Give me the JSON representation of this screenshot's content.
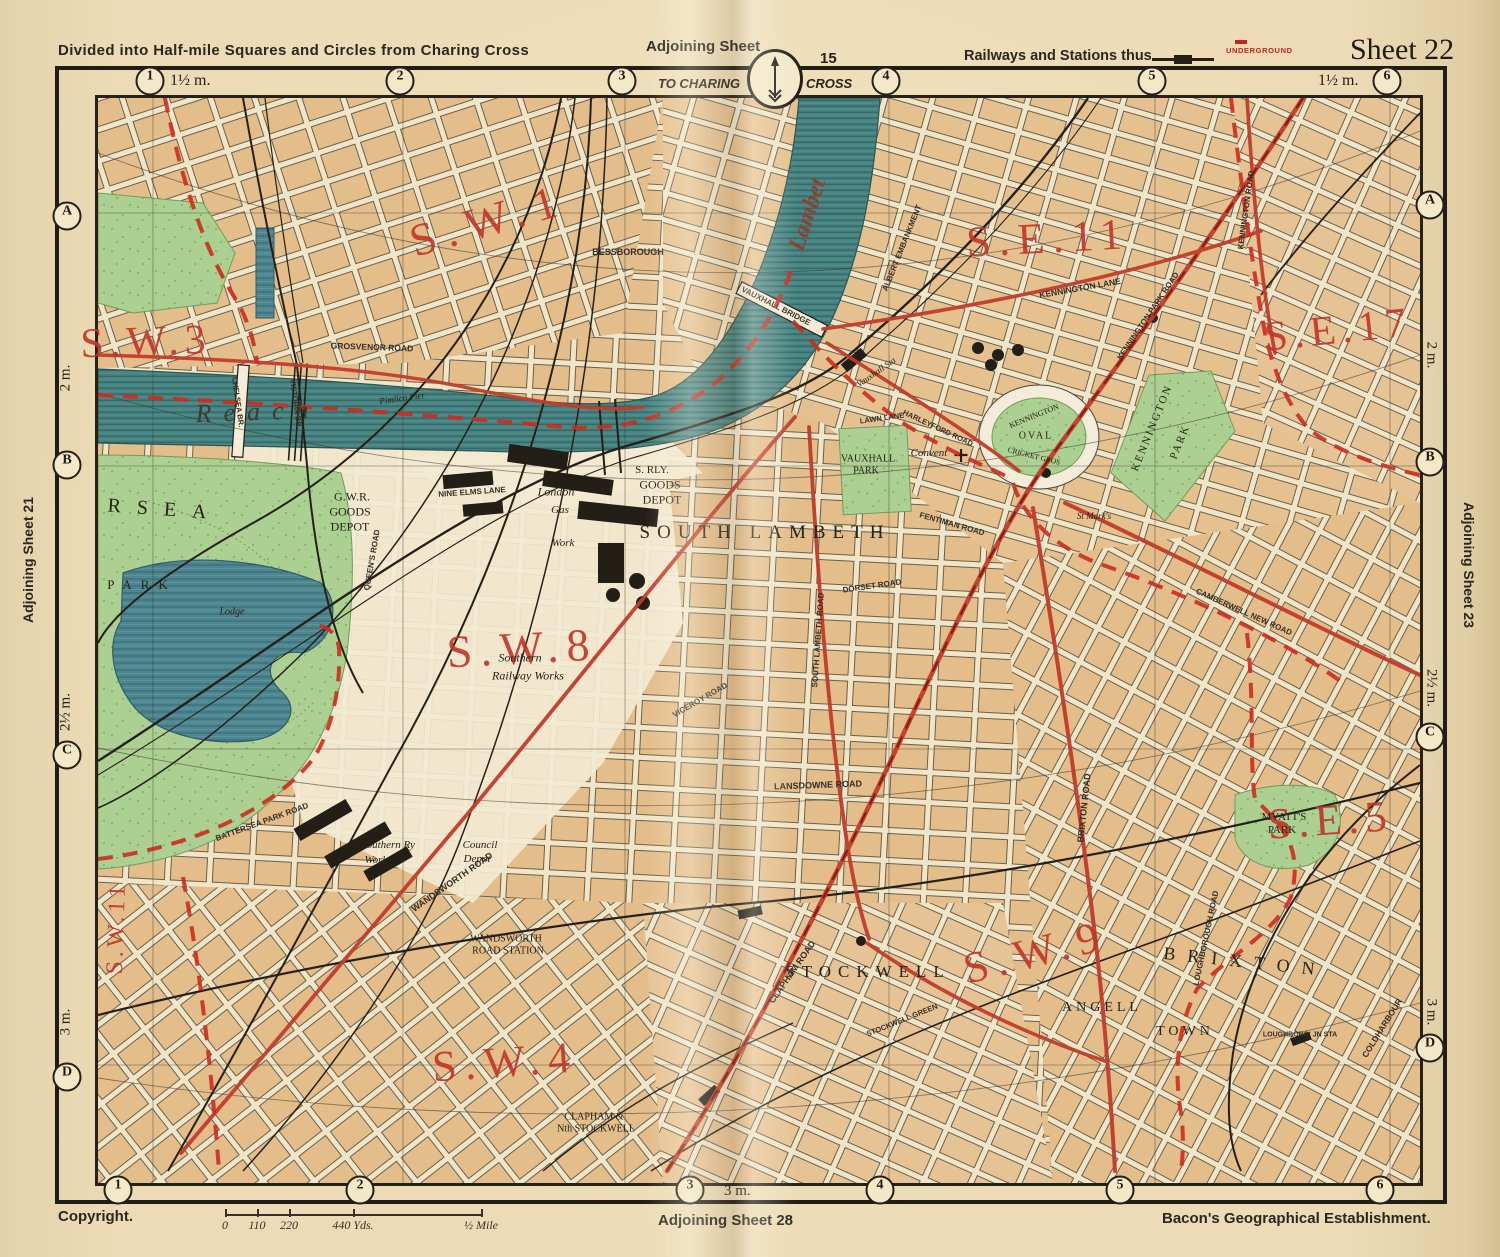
{
  "header": {
    "left": "Divided into Half-mile Squares and Circles from Charing Cross",
    "adjoining_top": "Adjoining Sheet",
    "adjoining_top_num": "15",
    "railways_legend": "Railways and Stations thus",
    "underground_label": "UNDERGROUND",
    "sheet": "Sheet 22",
    "to_charing": "TO CHARING",
    "cross": "CROSS",
    "compass_icon": "north-arrow"
  },
  "footer": {
    "copyright": "Copyright.",
    "adjoining_bottom": "Adjoining Sheet 28",
    "publisher": "Bacon's Geographical Establishment.",
    "three_m": "3 m.",
    "scale_ticks": [
      {
        "label": "0",
        "x": 225
      },
      {
        "label": "110",
        "x": 257
      },
      {
        "label": "220",
        "x": 289
      },
      {
        "label": "440 Yds.",
        "x": 353
      },
      {
        "label": "½ Mile",
        "x": 481
      }
    ]
  },
  "edges": {
    "top_circles": [
      {
        "n": "1",
        "x": 150
      },
      {
        "n": "2",
        "x": 400
      },
      {
        "n": "3",
        "x": 622
      },
      {
        "n": "4",
        "x": 886
      },
      {
        "n": "5",
        "x": 1152
      },
      {
        "n": "6",
        "x": 1387
      }
    ],
    "bottom_circles": [
      {
        "n": "1",
        "x": 118
      },
      {
        "n": "2",
        "x": 360
      },
      {
        "n": "3",
        "x": 690
      },
      {
        "n": "4",
        "x": 880
      },
      {
        "n": "5",
        "x": 1120
      },
      {
        "n": "6",
        "x": 1380
      }
    ],
    "top_dist_left": "1½ m.",
    "top_dist_right": "1½ m.",
    "left_letters": [
      {
        "l": "A",
        "y": 216
      },
      {
        "l": "B",
        "y": 465
      },
      {
        "l": "C",
        "y": 755
      },
      {
        "l": "D",
        "y": 1077
      }
    ],
    "right_letters": [
      {
        "l": "A",
        "y": 205
      },
      {
        "l": "B",
        "y": 462
      },
      {
        "l": "C",
        "y": 737
      },
      {
        "l": "D",
        "y": 1048
      }
    ],
    "left_dists": [
      {
        "label": "2 m.",
        "y": 378
      },
      {
        "label": "2½ m.",
        "y": 712
      },
      {
        "label": "3 m.",
        "y": 1022
      }
    ],
    "right_dists": [
      {
        "label": "2 m.",
        "y": 355
      },
      {
        "label": "2½ m.",
        "y": 688
      },
      {
        "label": "3 m.",
        "y": 1012
      }
    ],
    "adjoining_left": "Adjoining Sheet 21",
    "adjoining_right": "Adjoining Sheet 23"
  },
  "colors": {
    "paper": "#ebdab5",
    "ink": "#26211a",
    "district_red": "#c23429",
    "road_red": "#c23c2b",
    "boundary_red": "#cf2b1d",
    "water": "#478381",
    "park": "#accf92",
    "block_tan": "#e3bd8a"
  },
  "map": {
    "labels": [
      {
        "text": "S.W.1",
        "x": 488,
        "y": 220,
        "size": 46,
        "rot": -16,
        "sp": 10,
        "cls": "district"
      },
      {
        "text": "S.W.3",
        "x": 146,
        "y": 342,
        "size": 42,
        "rot": -2,
        "sp": 6,
        "cls": "district"
      },
      {
        "text": "S.E.11",
        "x": 1048,
        "y": 238,
        "size": 44,
        "rot": -3,
        "sp": 8,
        "cls": "district"
      },
      {
        "text": "S.E.17",
        "x": 1338,
        "y": 330,
        "size": 42,
        "rot": -6,
        "sp": 6,
        "cls": "district"
      },
      {
        "text": "S.W.8",
        "x": 522,
        "y": 648,
        "size": 46,
        "rot": -3,
        "sp": 8,
        "cls": "district"
      },
      {
        "text": "S.W.9",
        "x": 1035,
        "y": 952,
        "size": 44,
        "rot": -14,
        "sp": 8,
        "cls": "district"
      },
      {
        "text": "S.W.4",
        "x": 505,
        "y": 1062,
        "size": 44,
        "rot": -4,
        "sp": 8,
        "cls": "district"
      },
      {
        "text": "S.E.5",
        "x": 1330,
        "y": 820,
        "size": 44,
        "rot": -4,
        "sp": 6,
        "cls": "district"
      },
      {
        "text": "S.W.11",
        "x": 117,
        "y": 928,
        "size": 24,
        "rot": -88,
        "sp": 4,
        "cls": "district"
      },
      {
        "text": "SOUTH LAMBETH",
        "x": 765,
        "y": 533,
        "size": 19,
        "sp": 7,
        "cls": "place"
      },
      {
        "text": "STOCKWELL",
        "x": 868,
        "y": 972,
        "size": 17,
        "sp": 7,
        "cls": "place"
      },
      {
        "text": "BRIXTON",
        "x": 1245,
        "y": 962,
        "size": 18,
        "sp": 12,
        "rot": 6,
        "cls": "place"
      },
      {
        "text": "ANGELL",
        "x": 1102,
        "y": 1008,
        "size": 14,
        "sp": 4,
        "cls": "place"
      },
      {
        "text": "TOWN",
        "x": 1185,
        "y": 1032,
        "size": 14,
        "sp": 4,
        "cls": "place"
      },
      {
        "text": "RSEA",
        "x": 165,
        "y": 510,
        "size": 20,
        "sp": 16,
        "rot": 4,
        "cls": "place"
      },
      {
        "text": "PARK",
        "x": 142,
        "y": 585,
        "size": 13,
        "sp": 9,
        "cls": "place"
      },
      {
        "text": "Lodge",
        "x": 232,
        "y": 612,
        "size": 10,
        "cls": "place-i"
      },
      {
        "text": "G.W.R.",
        "x": 352,
        "y": 497,
        "size": 12,
        "cls": "place"
      },
      {
        "text": "GOODS",
        "x": 350,
        "y": 512,
        "size": 12,
        "cls": "place"
      },
      {
        "text": "DEPOT",
        "x": 350,
        "y": 527,
        "size": 12,
        "cls": "place"
      },
      {
        "text": "S. RLY.",
        "x": 652,
        "y": 470,
        "size": 11,
        "cls": "place"
      },
      {
        "text": "GOODS",
        "x": 660,
        "y": 485,
        "size": 12,
        "cls": "place"
      },
      {
        "text": "DEPOT",
        "x": 662,
        "y": 500,
        "size": 12,
        "cls": "place"
      },
      {
        "text": "London",
        "x": 556,
        "y": 492,
        "size": 12,
        "cls": "place-i"
      },
      {
        "text": "Gas",
        "x": 560,
        "y": 510,
        "size": 11,
        "cls": "place-i"
      },
      {
        "text": "Work",
        "x": 563,
        "y": 543,
        "size": 11,
        "cls": "place-i"
      },
      {
        "text": "Southern",
        "x": 520,
        "y": 658,
        "size": 12,
        "cls": "place-i"
      },
      {
        "text": "Railway Works",
        "x": 528,
        "y": 676,
        "size": 12,
        "cls": "place-i"
      },
      {
        "text": "Southern Ry",
        "x": 388,
        "y": 845,
        "size": 11,
        "cls": "place-i"
      },
      {
        "text": "Works",
        "x": 378,
        "y": 860,
        "size": 11,
        "cls": "place-i"
      },
      {
        "text": "Council",
        "x": 480,
        "y": 845,
        "size": 11,
        "cls": "place-i"
      },
      {
        "text": "Depot",
        "x": 477,
        "y": 859,
        "size": 11,
        "cls": "place-i"
      },
      {
        "text": "WANDSWORTH",
        "x": 506,
        "y": 939,
        "size": 10,
        "cls": "place"
      },
      {
        "text": "ROAD STATION",
        "x": 508,
        "y": 951,
        "size": 10,
        "cls": "place"
      },
      {
        "text": "CLAPHAM &",
        "x": 594,
        "y": 1117,
        "size": 10,
        "cls": "place"
      },
      {
        "text": "Nth STOCKWELL",
        "x": 596,
        "y": 1129,
        "size": 10,
        "cls": "place"
      },
      {
        "text": "VAUXHALL",
        "x": 868,
        "y": 459,
        "size": 10,
        "cls": "place"
      },
      {
        "text": "PARK",
        "x": 866,
        "y": 471,
        "size": 10,
        "cls": "place"
      },
      {
        "text": "Convent",
        "x": 929,
        "y": 453,
        "size": 11,
        "cls": "place-i"
      },
      {
        "text": "KENNINGTON",
        "x": 1034,
        "y": 416,
        "size": 8,
        "rot": -22,
        "cls": "place"
      },
      {
        "text": "OVAL",
        "x": 1036,
        "y": 436,
        "size": 10,
        "sp": 2,
        "cls": "place"
      },
      {
        "text": "CRICKET GROS",
        "x": 1034,
        "y": 456,
        "size": 7.5,
        "rot": 14,
        "cls": "place"
      },
      {
        "text": "KENNINGTON",
        "x": 1152,
        "y": 428,
        "size": 11,
        "rot": -68,
        "sp": 2,
        "cls": "place"
      },
      {
        "text": "PARK",
        "x": 1180,
        "y": 442,
        "size": 11,
        "rot": -68,
        "sp": 2,
        "cls": "place"
      },
      {
        "text": "MYATT'S",
        "x": 1284,
        "y": 817,
        "size": 11,
        "cls": "place"
      },
      {
        "text": "PARK",
        "x": 1282,
        "y": 830,
        "size": 11,
        "cls": "place"
      },
      {
        "text": "Reach",
        "x": 258,
        "y": 412,
        "size": 26,
        "sp": 12,
        "rot": -2,
        "cls": "river"
      },
      {
        "text": "Lambet",
        "x": 808,
        "y": 215,
        "size": 24,
        "rot": -72,
        "cls": "river2"
      },
      {
        "text": "Vauxhall Sta",
        "x": 876,
        "y": 372,
        "size": 9,
        "rot": -35,
        "cls": "place-i"
      },
      {
        "text": "Pimlico Pier",
        "x": 402,
        "y": 398,
        "size": 9,
        "rot": -8,
        "cls": "place-i"
      },
      {
        "text": "St Mark's",
        "x": 1094,
        "y": 516,
        "size": 9,
        "cls": "place-i"
      },
      {
        "text": "BESSBOROUGH",
        "x": 628,
        "y": 252,
        "size": 9,
        "cls": "road"
      },
      {
        "text": "VAUXHALL BRIDGE",
        "x": 776,
        "y": 306,
        "size": 8,
        "rot": 27,
        "cls": "road"
      },
      {
        "text": "CHELSEA BR.",
        "x": 238,
        "y": 402,
        "size": 7.5,
        "rot": 82,
        "cls": "road"
      },
      {
        "text": "VICTORIA BR.",
        "x": 296,
        "y": 404,
        "size": 7.5,
        "rot": 82,
        "cls": "road"
      },
      {
        "text": "GROSVENOR ROAD",
        "x": 372,
        "y": 347,
        "size": 8.5,
        "rot": 2,
        "cls": "road"
      },
      {
        "text": "ALBERT EMBANKMENT",
        "x": 902,
        "y": 248,
        "size": 8,
        "rot": -68,
        "cls": "road"
      },
      {
        "text": "KENNINGTON LANE",
        "x": 1080,
        "y": 288,
        "size": 8.5,
        "rot": -10,
        "cls": "road"
      },
      {
        "text": "KENNINGTON PARK ROAD",
        "x": 1148,
        "y": 316,
        "size": 8,
        "rot": -56,
        "cls": "road"
      },
      {
        "text": "KENNINGTON ROAD",
        "x": 1246,
        "y": 210,
        "size": 8,
        "rot": -82,
        "cls": "road"
      },
      {
        "text": "WANDSWORTH ROAD",
        "x": 452,
        "y": 882,
        "size": 9,
        "rot": -35,
        "cls": "road"
      },
      {
        "text": "LANSDOWNE ROAD",
        "x": 818,
        "y": 785,
        "size": 9,
        "rot": -2,
        "cls": "road"
      },
      {
        "text": "CLAPHAM ROAD",
        "x": 792,
        "y": 972,
        "size": 9,
        "rot": -55,
        "cls": "road"
      },
      {
        "text": "BRIXTON ROAD",
        "x": 1084,
        "y": 808,
        "size": 9,
        "rot": -84,
        "cls": "road"
      },
      {
        "text": "SOUTH LAMBETH ROAD",
        "x": 818,
        "y": 640,
        "size": 8,
        "rot": -86,
        "cls": "road"
      },
      {
        "text": "LOUGHBOROUGH ROAD",
        "x": 1206,
        "y": 938,
        "size": 8,
        "rot": -78,
        "cls": "road"
      },
      {
        "text": "LOUGHBORO' JN STA",
        "x": 1300,
        "y": 1035,
        "size": 7,
        "cls": "road"
      },
      {
        "text": "COLDHARBOUR",
        "x": 1382,
        "y": 1028,
        "size": 8.5,
        "rot": -58,
        "cls": "road"
      },
      {
        "text": "STOCKWELL GREEN",
        "x": 902,
        "y": 1020,
        "size": 7.5,
        "rot": -22,
        "cls": "road"
      },
      {
        "text": "FENTIMAN ROAD",
        "x": 952,
        "y": 524,
        "size": 8,
        "rot": 16,
        "cls": "road"
      },
      {
        "text": "HARLEYFORD ROAD",
        "x": 938,
        "y": 428,
        "size": 7.5,
        "rot": 25,
        "cls": "road"
      },
      {
        "text": "CAMBERWELL NEW ROAD",
        "x": 1244,
        "y": 612,
        "size": 8,
        "rot": 24,
        "cls": "road"
      },
      {
        "text": "NINE ELMS LANE",
        "x": 472,
        "y": 492,
        "size": 8,
        "rot": -4,
        "cls": "road"
      },
      {
        "text": "QUEEN'S ROAD",
        "x": 372,
        "y": 560,
        "size": 8,
        "rot": -80,
        "cls": "road"
      },
      {
        "text": "LAWN LANE",
        "x": 882,
        "y": 418,
        "size": 7.5,
        "rot": -8,
        "cls": "road"
      },
      {
        "text": "BATTERSEA PARK ROAD",
        "x": 262,
        "y": 822,
        "size": 8,
        "rot": -20,
        "cls": "road"
      },
      {
        "text": "DORSET ROAD",
        "x": 872,
        "y": 586,
        "size": 8,
        "rot": -8,
        "cls": "road"
      },
      {
        "text": "VICEROY ROAD",
        "x": 700,
        "y": 700,
        "size": 8,
        "rot": -30,
        "cls": "road"
      }
    ]
  }
}
